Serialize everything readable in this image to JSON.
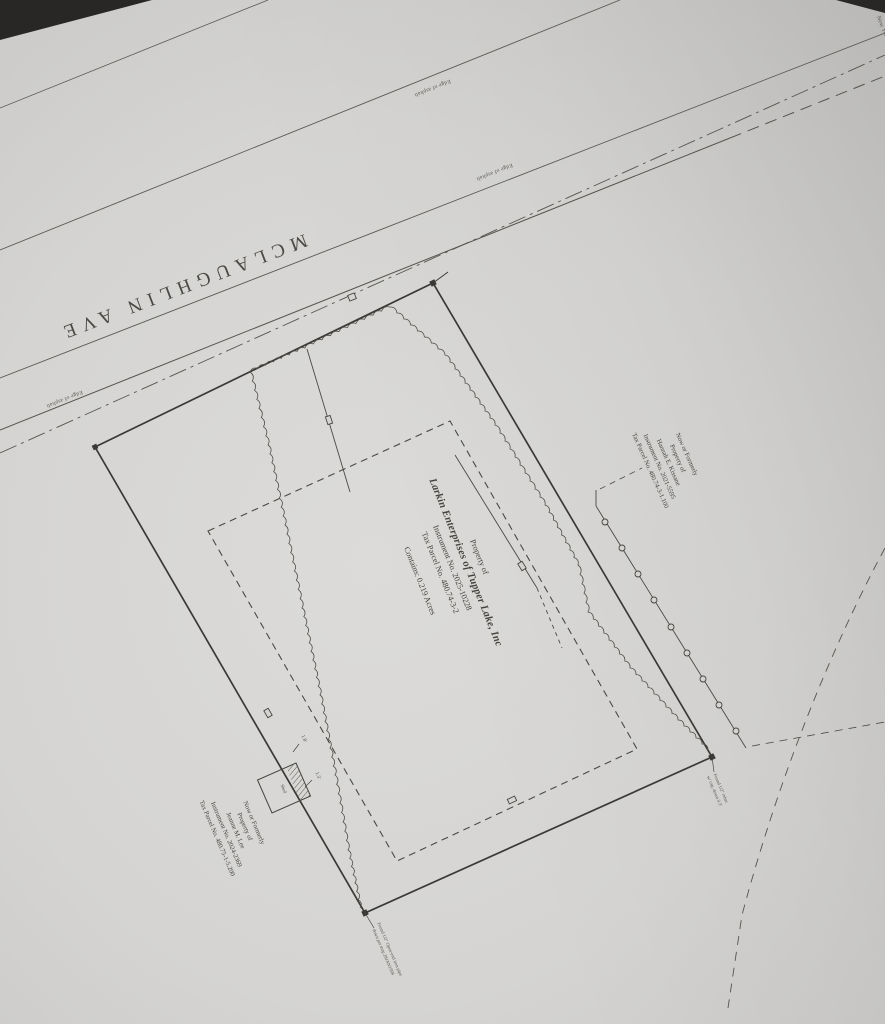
{
  "street": {
    "name": "MCLAUGHLIN AVE"
  },
  "edge_of_asphalt": [
    "Edge of asphalt",
    "Edge of asphalt",
    "Edge of asphalt"
  ],
  "parcel": {
    "property_of": "Property of",
    "owner": "Larkin Enterprises of Tupper Lake, Inc",
    "instrument": "Instrument No. 2025-10228",
    "tax_parcel": "Tax Parcel No. 480.74-3-2",
    "contains": "Contains: 0.219 Acres"
  },
  "neighbor_east": {
    "line1": "Now or Formerly",
    "line2": "Property of",
    "line3": "Hannah E. Kissane",
    "line4": "Instrument No. 2021-5595",
    "line5": "Tax Parcel No. 480.74-3-1.100"
  },
  "neighbor_south": {
    "line1": "Now or Formerly",
    "line2": "Property of",
    "line3": "Jeanne M. Lee",
    "line4": "Instrument No. 2024-2369",
    "line5": "Tax Parcel No. 480.75-1-5.200"
  },
  "shed": {
    "label": "Shed",
    "offset_ne": "1.8'",
    "offset_se": "1.3'"
  },
  "monuments": {
    "southeast": [
      "Found 1/2\" rebar",
      "w/ cap, down 0.3'"
    ],
    "south": [
      "Found 1/2\" Open-end iron pipe",
      "down per map 28JAN1998"
    ]
  },
  "page_edge_text": {
    "fragment": "New York"
  },
  "colors": {
    "paper": "#d5d4d2",
    "ink": "#45443f",
    "background": "#282725"
  }
}
